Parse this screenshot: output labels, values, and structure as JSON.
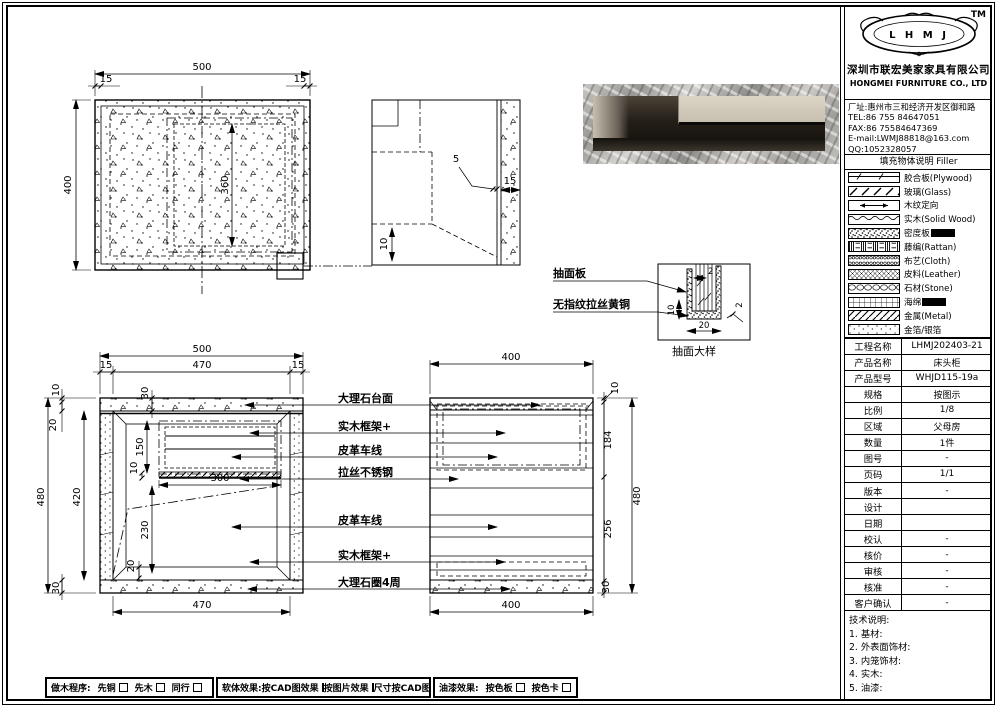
{
  "company": {
    "logo_text": "L H M J",
    "tm": "TM",
    "name_cn": "深圳市联宏美家家具有限公司",
    "name_en": "HONGMEI FURNITURE CO., LTD",
    "address": "厂址:惠州市三和经济开发区御和路",
    "tel": "TEL:86 755 84647051",
    "fax": "FAX:86 75584647369",
    "email": "E-mail:LWMJ88818@163.com",
    "qq": "QQ:1052328057"
  },
  "legend": {
    "title": "填充物体说明  Filler",
    "items": [
      {
        "label": "胶合板(Plywood)"
      },
      {
        "label": "玻璃(Glass)"
      },
      {
        "label": "木纹定向"
      },
      {
        "label": "实木(Solid Wood)"
      },
      {
        "label": "密度板"
      },
      {
        "label": "藤编(Rattan)"
      },
      {
        "label": "布艺(Cloth)"
      },
      {
        "label": "皮料(Leather)"
      },
      {
        "label": "石材(Stone)"
      },
      {
        "label": "海绵"
      },
      {
        "label": "金属(Metal)"
      },
      {
        "label": "金箔/银箔"
      }
    ]
  },
  "info_table": {
    "rows": [
      {
        "label": "工程名称",
        "value": "LHMJ202403-21"
      },
      {
        "label": "产品名称",
        "value": "床头柜"
      },
      {
        "label": "产品型号",
        "value": "WHJD115-19a"
      },
      {
        "label": "规格",
        "value": "按图示"
      },
      {
        "label": "比例",
        "value": "1/8"
      },
      {
        "label": "区域",
        "value": "父母房"
      },
      {
        "label": "数量",
        "value": "1件"
      },
      {
        "label": "图号",
        "value": "-"
      },
      {
        "label": "页码",
        "value": "1/1"
      },
      {
        "label": "版本",
        "value": "-"
      },
      {
        "label": "设计",
        "value": ""
      },
      {
        "label": "日期",
        "value": ""
      },
      {
        "label": "校认",
        "value": "-"
      },
      {
        "label": "核价",
        "value": "-"
      },
      {
        "label": "审核",
        "value": "-"
      },
      {
        "label": "核准",
        "value": "-"
      },
      {
        "label": "客户确认",
        "value": "-"
      }
    ]
  },
  "tech_notes": {
    "title": "技术说明:",
    "items": [
      "1. 基材:",
      "2. 外表面饰材:",
      "3. 内笼饰材:",
      "4. 实木:",
      "5. 油漆:"
    ]
  },
  "footer": {
    "box1": {
      "label": "做木程序:",
      "options": [
        "先铜",
        "先木",
        "同行"
      ]
    },
    "box2": {
      "label": "软体效果:",
      "options": [
        "按CAD图效果",
        "按图片效果",
        "尺寸按CAD图纸"
      ]
    },
    "box3": {
      "label": "油漆效果:",
      "options": [
        "按色板",
        "按色卡"
      ]
    }
  },
  "drawing": {
    "dims": {
      "d500": "500",
      "d470": "470",
      "d480": "480",
      "d420": "420",
      "d400": "400",
      "d360": "360",
      "d300": "300",
      "d256": "256",
      "d230": "230",
      "d184": "184",
      "d150": "150",
      "d30": "30",
      "d20": "20",
      "d15": "15",
      "d10": "10",
      "d5": "5",
      "d2": "2"
    },
    "labels": [
      "大理石台面",
      "实木框架+",
      "皮革车线",
      "拉丝不锈钢",
      "皮革车线",
      "实木框架+",
      "大理石圈4周"
    ],
    "callouts": {
      "drawer_face": "抽面板",
      "brass": "无指纹拉丝黄铜",
      "detail_caption": "抽面大样"
    }
  },
  "photo_colors": {
    "marble": "#b9b6b1",
    "drawer_front": "#d2cbba",
    "cavity": "#1c1813"
  }
}
